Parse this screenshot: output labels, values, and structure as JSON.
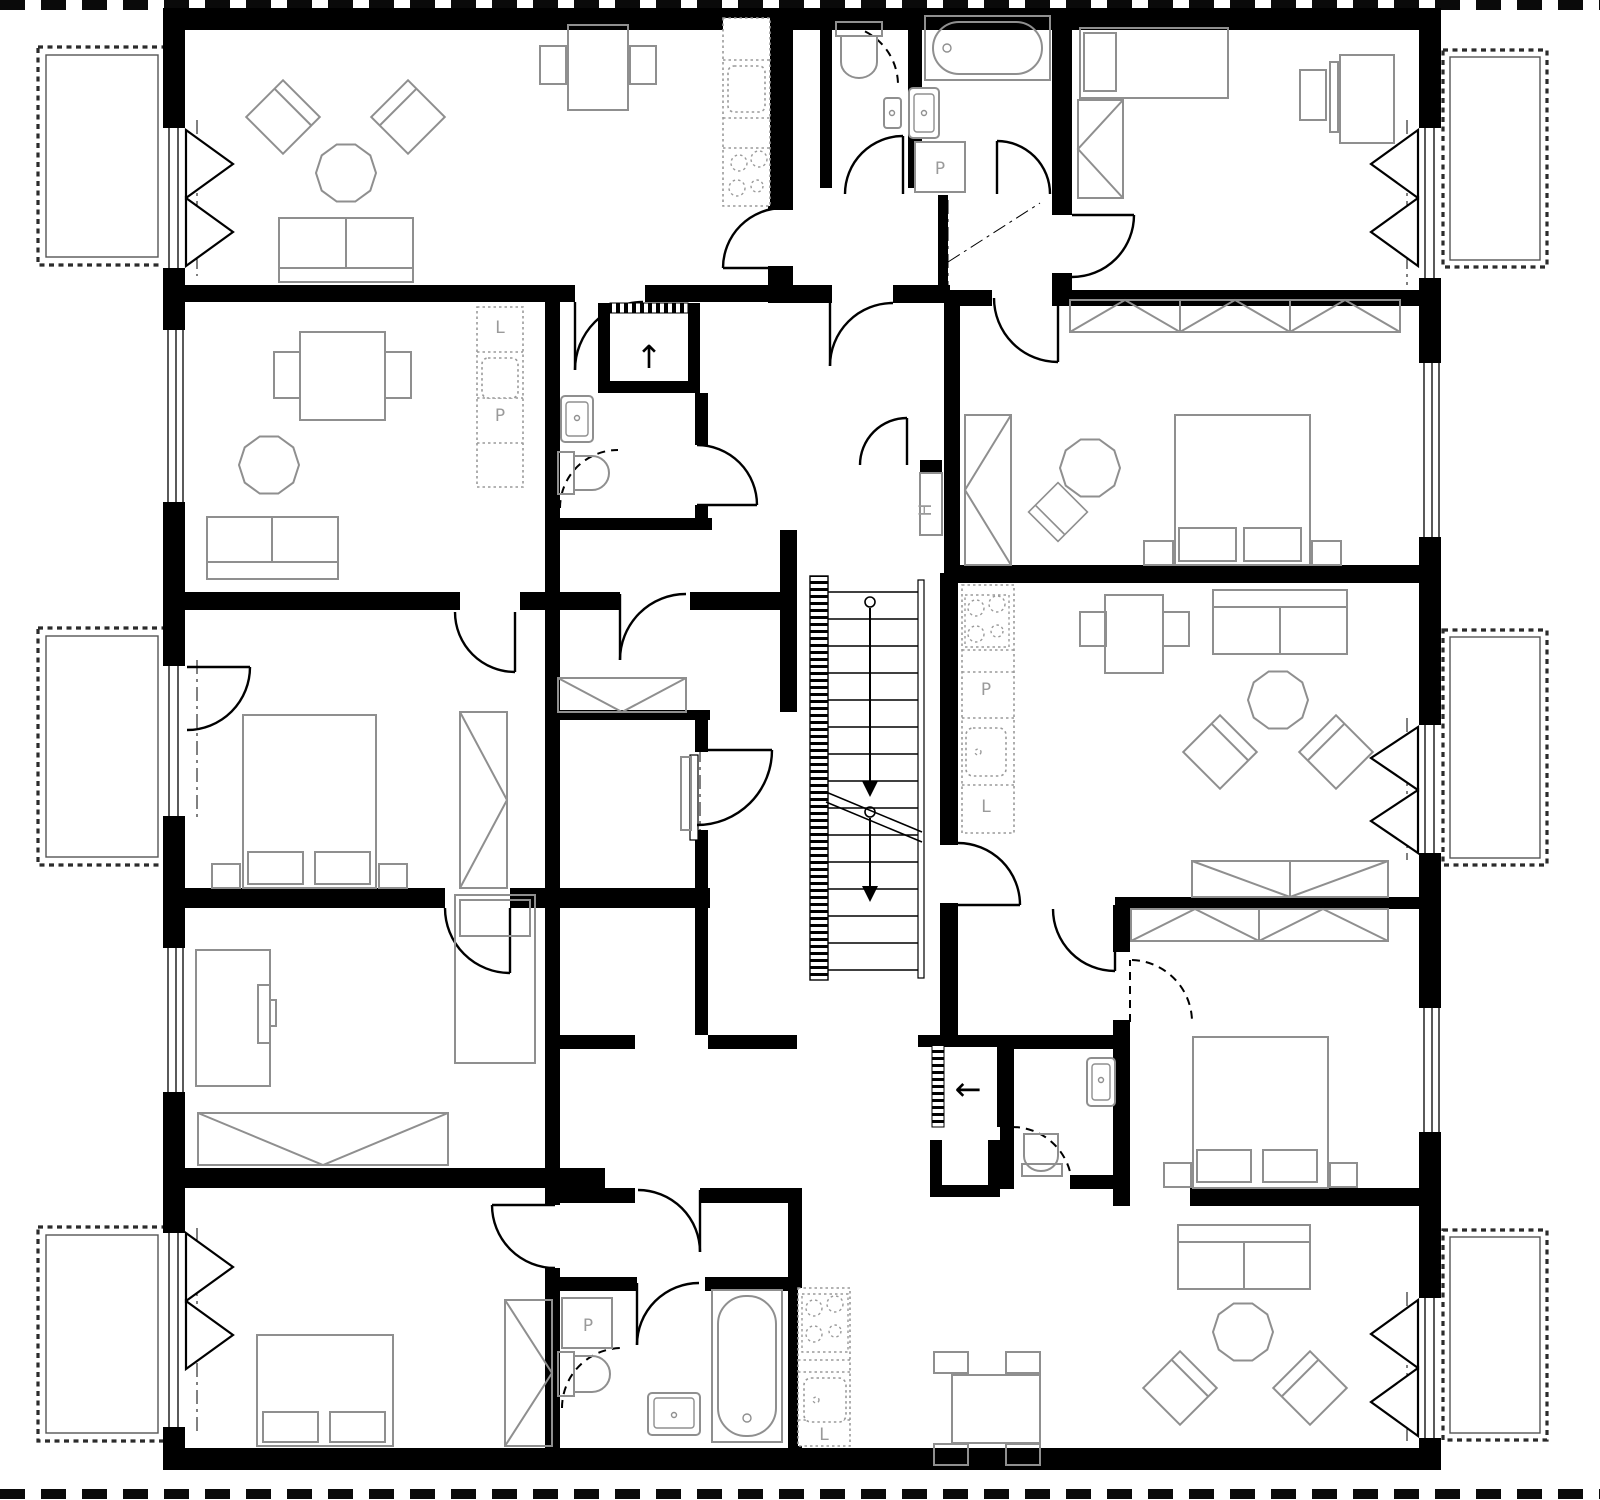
{
  "canvas": {
    "width": 1600,
    "height": 1500
  },
  "colors": {
    "background": "#ffffff",
    "walls": "#000000",
    "furniture_stroke": "#8f8f8f",
    "kitchen_dotted_stroke": "#9a9a9a",
    "door_stroke": "#000000",
    "balcony_dash_stroke": "#2b2b2b",
    "label_text": "#9a9a9a",
    "arrow": "#000000"
  },
  "annotations": [
    {
      "id": "appliance-p-top-bathroom",
      "text": "P"
    },
    {
      "id": "appliance-l-left-kitchen",
      "text": "L"
    },
    {
      "id": "appliance-p-left-kitchen",
      "text": "P"
    },
    {
      "id": "shaft-h-stairwell",
      "text": "H"
    },
    {
      "id": "appliance-p-center-kitchen",
      "text": "P"
    },
    {
      "id": "appliance-l-center-kitchen",
      "text": "L"
    },
    {
      "id": "appliance-p-bottom-bathroom",
      "text": "P"
    },
    {
      "id": "appliance-l-bottom-kitchen",
      "text": "L"
    }
  ],
  "icons": {
    "lift_up_arrow": "↑",
    "exit_left_arrow": "←",
    "stair_down_arrow": "↓"
  }
}
